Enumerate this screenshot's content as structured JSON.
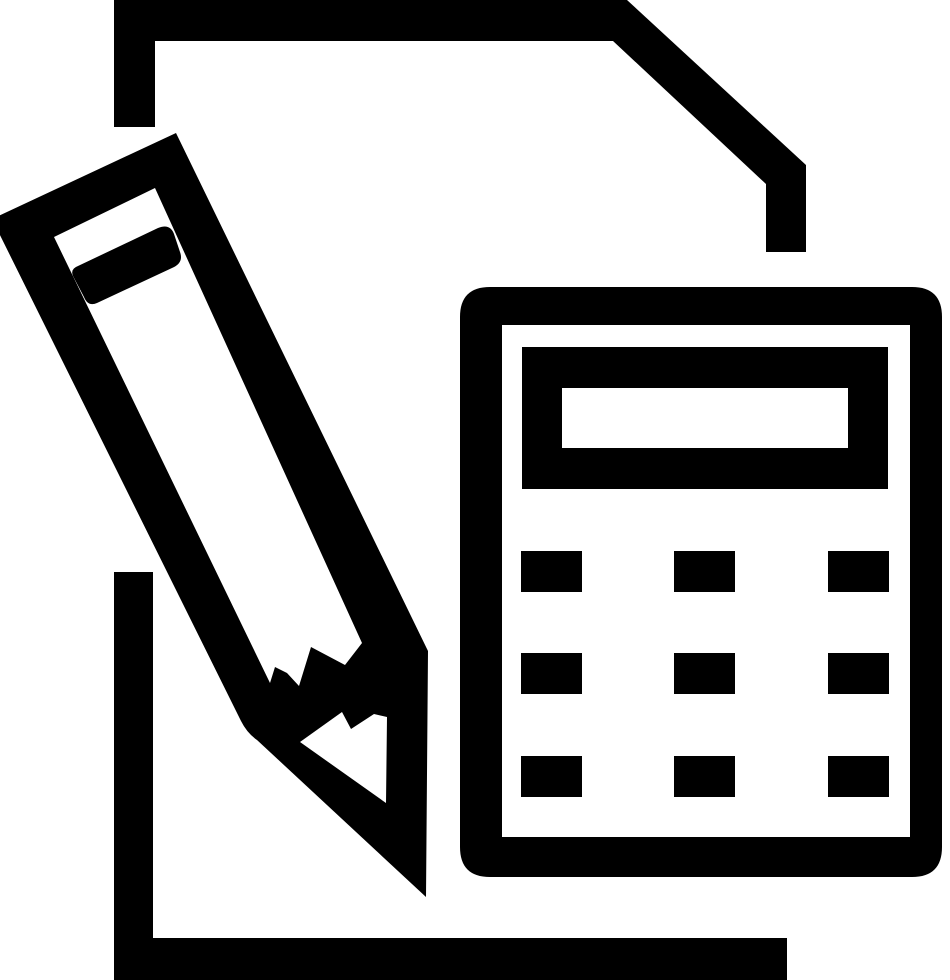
{
  "icon": {
    "name": "document-pencil-calculator-icon",
    "description": "Black glyph icon: paper sheet with folded top-right corner, a broken-tip pencil lying diagonally across it, and a calculator with display and nine keys",
    "colors": {
      "foreground": "#000000",
      "background": "#ffffff"
    },
    "canvas": {
      "width": 950,
      "height": 980
    },
    "parts": {
      "document_top": {
        "label": "document top outline with folded corner",
        "path": "M114,0 H627 L806,165 V252 H766 V184 L613,41 H155 V127 H114 Z"
      },
      "document_bottom": {
        "label": "document bottom-left outline",
        "path": "M114,572 H153 V938 H787 V980 H114 Z"
      },
      "pencil_body": {
        "label": "pencil with broken zigzag tip",
        "path": "M176,133 L-8,219 L241,721 Q247,733 257,740 L426,897 L428,651 Z M155,188 L54,237 L270,683 L275,667 L287,673 L299,686 L311,647 L345,665 L362,643 Z M300,742 L342,712 L351,729 L374,714 L387,717 L386,803 Z"
      },
      "pencil_eraser_band": {
        "label": "pencil eraser separator band",
        "path": "M78,266 L158,228 Q170,223 174,234 L180,252 Q184,263 172,268 L97,303 Q88,307 84,297 L73,276 Q70,269 78,266 Z"
      },
      "calculator_body": {
        "label": "calculator rounded frame",
        "path": "M490,287 H912 Q942,287 942,317 V847 Q942,877 912,877 H490 Q460,877 460,847 V317 Q460,287 490,287 Z M502,325 H910 V837 H502 Z"
      },
      "calculator_display": {
        "label": "calculator display with screen window",
        "path": "M522,347 H888 V489 H522 Z M562,388 H848 V448 H562 Z"
      },
      "calculator_buttons": {
        "label": "calculator keypad, 3 rows by 3 columns",
        "path": "M521,551 h61 v41 h-61 Z M674,551 h61 v41 h-61 Z M828,551 h61 v41 h-61 Z M521,653 h61 v41 h-61 Z M674,653 h61 v41 h-61 Z M828,653 h61 v41 h-61 Z M521,756 h61 v41 h-61 Z M674,756 h61 v41 h-61 Z M828,756 h61 v41 h-61 Z",
        "grid": {
          "column_x": [
            521,
            674,
            828
          ],
          "row_y": [
            551,
            653,
            756
          ],
          "key_width": 61,
          "key_height": 41
        }
      }
    }
  }
}
